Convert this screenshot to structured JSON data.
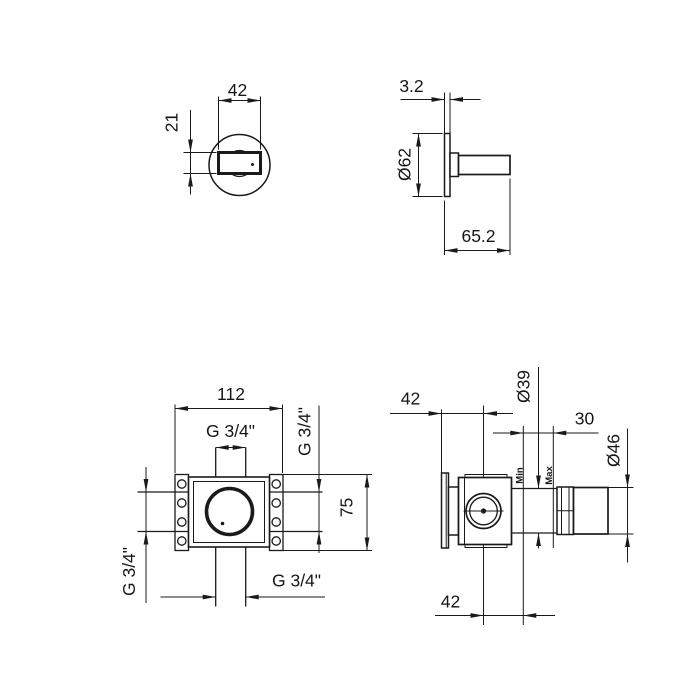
{
  "drawing_title": "valve-trim-dimension-drawing",
  "colors": {
    "ink": "#1a1a1a",
    "paper": "#ffffff"
  },
  "views": {
    "handle_front": {
      "width": "42",
      "height": "21"
    },
    "handle_side": {
      "thickness": "3.2",
      "diameter": "Ø62",
      "projection": "65.2"
    },
    "body_front": {
      "width": "112",
      "height": "75",
      "thread_top": "G 3/4\"",
      "thread_right": "G 3/4\"",
      "thread_left": "G 3/4\"",
      "thread_bottom": "G 3/4\""
    },
    "body_side": {
      "depth_to_center": "42",
      "cartridge_dia": "Ø39",
      "adjustment": "30",
      "cap_dia": "Ø46",
      "min_label": "Min",
      "max_label": "Max",
      "center_to_wall": "42"
    }
  }
}
